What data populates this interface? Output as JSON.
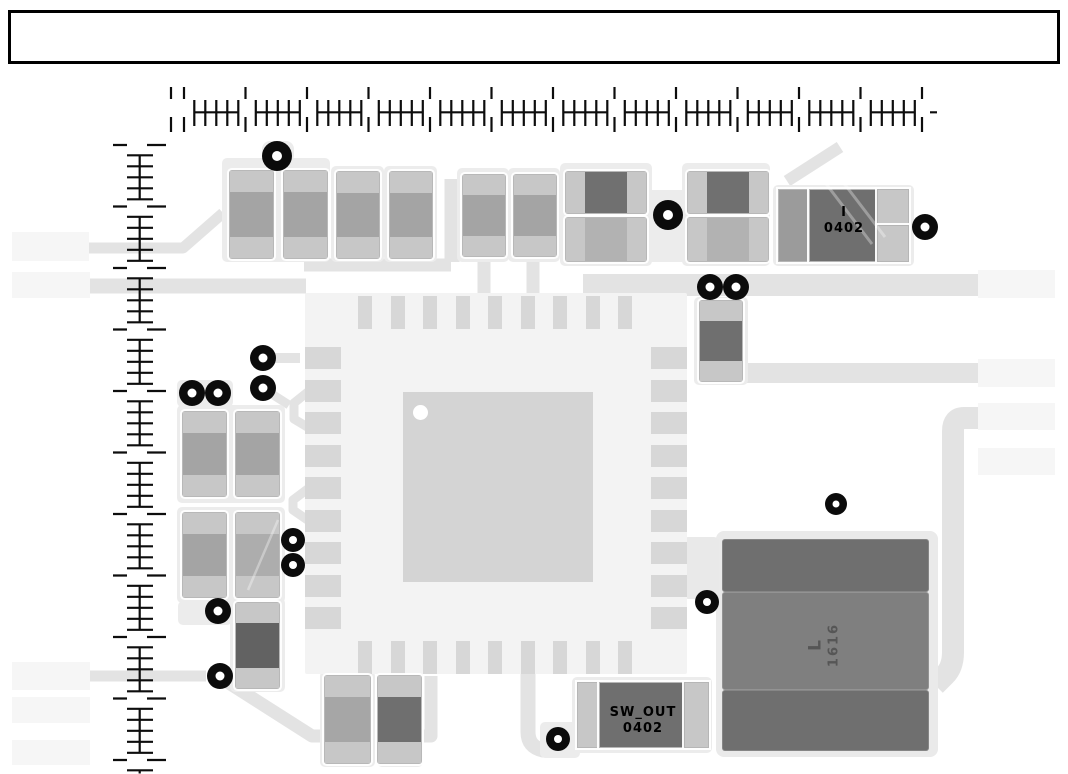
{
  "meta": {
    "view": "pcb-layout-assembly-view",
    "width": 1068,
    "height": 774
  },
  "title_block": {
    "text": ""
  },
  "labels": {
    "comp_i": {
      "line1": "I",
      "line2": "0402"
    },
    "sw_out": {
      "line1": "SW_OUT",
      "line2": "0402"
    },
    "inductor": {
      "line1": "L",
      "line2": "1616"
    }
  },
  "colors": {
    "trace": "#e3e3e3",
    "panel": "#ececec",
    "block": "#f6f6f6",
    "pad": "#c7c7c7",
    "body_medium": "#a4a4a4",
    "body_dark": "#6f6f6f",
    "body_light": "#b2b2b2",
    "ic_base": "#f3f3f3",
    "ic_pad": "#d7d7d7",
    "via": "#0b0b0b",
    "ruler": "#0d0d0d",
    "silk_text": "#000000",
    "inductor_mid": "#7f7f7f",
    "inductor_text": "#565656"
  },
  "blocks": [
    {
      "name": "left-pad-block-1",
      "x": 12,
      "y": 232,
      "w": 77,
      "h": 29
    },
    {
      "name": "left-pad-block-2",
      "x": 12,
      "y": 272,
      "w": 78,
      "h": 26
    },
    {
      "name": "left-pad-block-3",
      "x": 12,
      "y": 662,
      "w": 78,
      "h": 28
    },
    {
      "name": "left-pad-block-4",
      "x": 12,
      "y": 697,
      "w": 78,
      "h": 26
    },
    {
      "name": "left-pad-block-5",
      "x": 12,
      "y": 740,
      "w": 78,
      "h": 25
    },
    {
      "name": "right-pad-block-1",
      "x": 978,
      "y": 270,
      "w": 77,
      "h": 28
    },
    {
      "name": "right-pad-block-2",
      "x": 978,
      "y": 359,
      "w": 77,
      "h": 28
    },
    {
      "name": "right-pad-block-3",
      "x": 978,
      "y": 403,
      "w": 77,
      "h": 27
    },
    {
      "name": "right-pad-block-4",
      "x": 978,
      "y": 448,
      "w": 77,
      "h": 27
    }
  ],
  "panels": [
    {
      "name": "courtyard-top-pair",
      "x": 222,
      "y": 158,
      "w": 108,
      "h": 104
    },
    {
      "name": "courtyard-top-tab",
      "x": 262,
      "y": 141,
      "w": 32,
      "h": 22,
      "rx": 8
    },
    {
      "name": "courtyard-c3",
      "x": 331,
      "y": 166,
      "w": 53,
      "h": 96
    },
    {
      "name": "courtyard-c4",
      "x": 384,
      "y": 166,
      "w": 53,
      "h": 96
    },
    {
      "name": "courtyard-c5",
      "x": 457,
      "y": 168,
      "w": 52,
      "h": 94
    },
    {
      "name": "courtyard-c6",
      "x": 508,
      "y": 168,
      "w": 52,
      "h": 94
    },
    {
      "name": "courtyard-h12",
      "x": 560,
      "y": 163,
      "w": 92,
      "h": 103
    },
    {
      "name": "courtyard-h34",
      "x": 682,
      "y": 163,
      "w": 88,
      "h": 103
    },
    {
      "name": "courtyard-bridge",
      "x": 646,
      "y": 190,
      "w": 42,
      "h": 72
    },
    {
      "name": "courtyard-comp-i",
      "x": 773,
      "y": 185,
      "w": 141,
      "h": 81
    },
    {
      "name": "courtyard-v1",
      "x": 694,
      "y": 297,
      "w": 54,
      "h": 88
    },
    {
      "name": "courtyard-left-pair-1",
      "x": 177,
      "y": 405,
      "w": 108,
      "h": 98
    },
    {
      "name": "courtyard-left-pair-1-tab",
      "x": 177,
      "y": 380,
      "w": 56,
      "h": 27
    },
    {
      "name": "courtyard-left-pair-2",
      "x": 177,
      "y": 507,
      "w": 108,
      "h": 96
    },
    {
      "name": "courtyard-left-single",
      "x": 230,
      "y": 598,
      "w": 55,
      "h": 94
    },
    {
      "name": "courtyard-left-single-tab",
      "x": 178,
      "y": 601,
      "w": 54,
      "h": 24
    },
    {
      "name": "courtyard-bottom-a",
      "x": 320,
      "y": 671,
      "w": 55,
      "h": 96
    },
    {
      "name": "courtyard-bottom-b",
      "x": 377,
      "y": 671,
      "w": 46,
      "h": 96
    },
    {
      "name": "courtyard-sw-out",
      "x": 572,
      "y": 677,
      "w": 140,
      "h": 76
    },
    {
      "name": "courtyard-sw-tab",
      "x": 540,
      "y": 722,
      "w": 40,
      "h": 36
    },
    {
      "name": "courtyard-inductor",
      "x": 716,
      "y": 531,
      "w": 222,
      "h": 226,
      "fill": "#eaeaea",
      "rx": 8
    },
    {
      "name": "courtyard-inductor-left-tab",
      "x": 683,
      "y": 537,
      "w": 36,
      "h": 62,
      "fill": "#e9e9e9"
    }
  ],
  "components": [
    {
      "name": "chip-cap-c1",
      "x": 230,
      "y": 171,
      "w": 43,
      "h": 87,
      "o": "v",
      "pad": 21,
      "body": "#a4a4a4"
    },
    {
      "name": "chip-cap-c2",
      "x": 284,
      "y": 171,
      "w": 43,
      "h": 87,
      "o": "v",
      "pad": 21,
      "body": "#a4a4a4"
    },
    {
      "name": "chip-cap-c3",
      "x": 337,
      "y": 172,
      "w": 42,
      "h": 86,
      "o": "v",
      "pad": 21,
      "body": "#a4a4a4"
    },
    {
      "name": "chip-cap-c4",
      "x": 390,
      "y": 172,
      "w": 42,
      "h": 86,
      "o": "v",
      "pad": 21,
      "body": "#a4a4a4"
    },
    {
      "name": "chip-cap-c5",
      "x": 463,
      "y": 175,
      "w": 42,
      "h": 81,
      "o": "v",
      "pad": 20,
      "body": "#a4a4a4"
    },
    {
      "name": "chip-cap-c6",
      "x": 514,
      "y": 175,
      "w": 42,
      "h": 81,
      "o": "v",
      "pad": 20,
      "body": "#a4a4a4"
    },
    {
      "name": "chip-res-h1",
      "x": 566,
      "y": 172,
      "w": 80,
      "h": 41,
      "o": "h",
      "pad": 19,
      "body": "#707070"
    },
    {
      "name": "chip-res-h2",
      "x": 566,
      "y": 218,
      "w": 80,
      "h": 43,
      "o": "h",
      "pad": 19,
      "body": "#b2b2b2"
    },
    {
      "name": "chip-res-h3",
      "x": 688,
      "y": 172,
      "w": 80,
      "h": 41,
      "o": "h",
      "pad": 19,
      "body": "#707070"
    },
    {
      "name": "chip-res-h4",
      "x": 688,
      "y": 218,
      "w": 80,
      "h": 43,
      "o": "h",
      "pad": 19,
      "body": "#b2b2b2"
    },
    {
      "name": "chip-cap-v1",
      "x": 700,
      "y": 301,
      "w": 42,
      "h": 80,
      "o": "v",
      "pad": 20,
      "body": "#6f6f6f"
    },
    {
      "name": "chip-cap-l1a",
      "x": 183,
      "y": 412,
      "w": 43,
      "h": 84,
      "o": "v",
      "pad": 21,
      "body": "#a4a4a4"
    },
    {
      "name": "chip-cap-l1b",
      "x": 236,
      "y": 412,
      "w": 43,
      "h": 84,
      "o": "v",
      "pad": 21,
      "body": "#a4a4a4"
    },
    {
      "name": "chip-cap-l2a",
      "x": 183,
      "y": 513,
      "w": 43,
      "h": 84,
      "o": "v",
      "pad": 21,
      "body": "#a4a4a4"
    },
    {
      "name": "chip-cap-l2b",
      "x": 236,
      "y": 513,
      "w": 43,
      "h": 84,
      "o": "v",
      "pad": 21,
      "body": "#adadad"
    },
    {
      "name": "chip-cap-ls1",
      "x": 236,
      "y": 603,
      "w": 43,
      "h": 85,
      "o": "v",
      "pad": 20,
      "body": "#626262"
    },
    {
      "name": "chip-cap-ba",
      "x": 325,
      "y": 676,
      "w": 45,
      "h": 87,
      "o": "v",
      "pad": 21,
      "body": "#a6a6a6"
    },
    {
      "name": "chip-cap-bb",
      "x": 378,
      "y": 676,
      "w": 43,
      "h": 87,
      "o": "v",
      "pad": 21,
      "body": "#6f6f6f"
    }
  ],
  "custom_rects": [
    {
      "name": "comp-i-left-pad",
      "x": 779,
      "y": 190,
      "w": 31,
      "h": 71,
      "fill": "#9b9b9b",
      "framed": true
    },
    {
      "name": "comp-i-body",
      "x": 810,
      "y": 190,
      "w": 68,
      "h": 71,
      "fill": "#6f6f6f",
      "framed": true
    },
    {
      "name": "comp-i-right-pad-1",
      "x": 878,
      "y": 190,
      "w": 30,
      "h": 35,
      "fill": "#c7c7c7",
      "framed": true
    },
    {
      "name": "comp-i-right-pad-2",
      "x": 878,
      "y": 226,
      "w": 30,
      "h": 35,
      "fill": "#c7c7c7",
      "framed": true
    },
    {
      "name": "sw-out-left-pad",
      "x": 578,
      "y": 683,
      "w": 22,
      "h": 64,
      "fill": "#c7c7c7",
      "framed": true
    },
    {
      "name": "sw-out-body",
      "x": 600,
      "y": 683,
      "w": 85,
      "h": 64,
      "fill": "#6f6f6f",
      "framed": true
    },
    {
      "name": "sw-out-right-pad",
      "x": 685,
      "y": 683,
      "w": 23,
      "h": 64,
      "fill": "#c7c7c7",
      "framed": true
    },
    {
      "name": "inductor-pad-top",
      "x": 722,
      "y": 539,
      "w": 207,
      "h": 53,
      "fill": "#6f6f6f",
      "band": true
    },
    {
      "name": "inductor-body",
      "x": 722,
      "y": 592,
      "w": 207,
      "h": 98,
      "fill": "#7f7f7f",
      "band": true
    },
    {
      "name": "inductor-pad-bottom",
      "x": 722,
      "y": 690,
      "w": 207,
      "h": 61,
      "fill": "#6f6f6f",
      "band": true
    }
  ],
  "ic": {
    "name": "qfn-ic-u1",
    "x": 305,
    "y": 293,
    "w": 382,
    "h": 381,
    "pins_per_side": 9,
    "pitch": 32.5,
    "first_center_x": 365,
    "first_center_y": 358,
    "top_pad": {
      "w": 14,
      "h": 33,
      "y": 296
    },
    "bottom_pad": {
      "w": 14,
      "h": 33,
      "y": 641
    },
    "left_pad": {
      "w": 36,
      "h": 22,
      "x": 305
    },
    "right_pad": {
      "w": 36,
      "h": 22,
      "x": 651
    },
    "body": {
      "x": 403,
      "y": 392,
      "w": 190,
      "h": 190
    },
    "pin1_dot": {
      "cx": 420,
      "cy": 412,
      "r": 7.5
    }
  },
  "vias": [
    {
      "x": 277,
      "y": 156,
      "r": 15
    },
    {
      "x": 668,
      "y": 215,
      "r": 15
    },
    {
      "x": 925,
      "y": 227,
      "r": 13
    },
    {
      "x": 710,
      "y": 287,
      "r": 13
    },
    {
      "x": 736,
      "y": 287,
      "r": 13
    },
    {
      "x": 263,
      "y": 358,
      "r": 13
    },
    {
      "x": 192,
      "y": 393,
      "r": 13
    },
    {
      "x": 218,
      "y": 393,
      "r": 13
    },
    {
      "x": 263,
      "y": 388,
      "r": 13
    },
    {
      "x": 293,
      "y": 540,
      "r": 12
    },
    {
      "x": 293,
      "y": 565,
      "r": 12
    },
    {
      "x": 218,
      "y": 611,
      "r": 13
    },
    {
      "x": 220,
      "y": 676,
      "r": 13
    },
    {
      "x": 836,
      "y": 504,
      "r": 11
    },
    {
      "x": 707,
      "y": 602,
      "r": 12
    },
    {
      "x": 558,
      "y": 739,
      "r": 12
    }
  ],
  "traces": [
    {
      "name": "trace-top-bus",
      "d": "M583 285 H980",
      "w": 22
    },
    {
      "name": "trace-mid-bus",
      "d": "M740 373 H978",
      "w": 20
    },
    {
      "name": "trace-right-drop",
      "d": "M982 418 H964 Q953 418 953 431 V652 Q953 667 945 675 L935 685",
      "w": 22
    },
    {
      "name": "trace-left-1",
      "d": "M89 248 H183 L223 213",
      "w": 11
    },
    {
      "name": "trace-left-2",
      "d": "M90 286 H306",
      "w": 15
    },
    {
      "name": "trace-bottom-left",
      "d": "M90 676 H206",
      "w": 11
    },
    {
      "name": "trace-bottom-diag",
      "d": "M221 678 L312 736 H431 V676",
      "w": 13
    },
    {
      "name": "trace-sw-out",
      "d": "M528 672 V732 Q528 747 543 750 H568",
      "w": 15
    },
    {
      "name": "trace-top-link",
      "d": "M304 265 H451",
      "w": 13
    },
    {
      "name": "trace-top-vert",
      "d": "M452 262 V179",
      "w": 15
    },
    {
      "name": "trace-c5-stub",
      "d": "M484 256 V298",
      "w": 13
    },
    {
      "name": "trace-c6-stub",
      "d": "M533 256 V298",
      "w": 13
    },
    {
      "name": "trace-diag-comp-i",
      "d": "M840 147 L787 181",
      "w": 12
    },
    {
      "name": "trace-zigzag-1",
      "d": "M309 391 L294 403 V419 L309 428",
      "w": 9
    },
    {
      "name": "trace-zigzag-2",
      "d": "M309 488 L293 500 V510 L309 521",
      "w": 9
    },
    {
      "name": "trace-via-link-1",
      "d": "M264 389 L289 405",
      "w": 9
    },
    {
      "name": "trace-via-link-2",
      "d": "M264 358 H300",
      "w": 10
    }
  ],
  "overlay_lines": [
    {
      "name": "inner-trace-comp-i-1",
      "d": "M817 172 L872 244",
      "w": 3,
      "c": "rgba(255,255,255,0.32)"
    },
    {
      "name": "inner-trace-comp-i-2",
      "d": "M830 165 L885 237",
      "w": 3,
      "c": "rgba(255,255,255,0.32)"
    },
    {
      "name": "inner-trace-l2b",
      "d": "M278 520 L248 590",
      "w": 2.5,
      "c": "rgba(255,255,255,0.35)"
    }
  ],
  "rulers": {
    "horizontal": {
      "x0": 184,
      "period": 61.5,
      "count": 13,
      "lead_x": 171,
      "seg_top": [
        87,
        99
      ],
      "seg_bot": [
        117,
        132
      ],
      "tick_y": [
        100,
        126
      ],
      "base_y": 112.3,
      "offsets": [
        10.3,
        21.3,
        32.3,
        43.3,
        54.3
      ],
      "base_span": [
        9.3,
        55.3
      ],
      "tail_stub": [
        930,
        937
      ]
    },
    "vertical": {
      "y0": 145,
      "period": 61.5,
      "count": 11,
      "seg_left": [
        113,
        127
      ],
      "seg_right": [
        147,
        166
      ],
      "tick_x": [
        127,
        153
      ],
      "base_x": 139.7,
      "offsets": [
        10.3,
        21.3,
        32.3,
        43.3,
        54.3
      ],
      "base_span": [
        9.3,
        55.3
      ],
      "tail_ticks": [
        770.3
      ],
      "tail_base": [
        769.3,
        773.5
      ]
    }
  }
}
